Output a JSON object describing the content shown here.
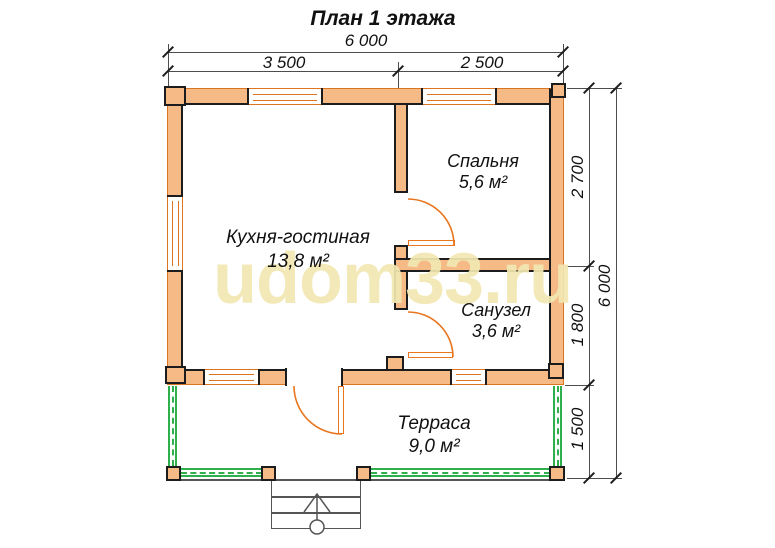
{
  "title": "План 1 этажа",
  "watermark": "udom33.ru",
  "dims": {
    "top_total": "6 000",
    "top_left": "3 500",
    "top_right": "2 500",
    "right_seg1": "2 700",
    "right_seg2": "1 800",
    "right_seg3": "1 500",
    "right_total": "6 000"
  },
  "rooms": {
    "kitchen": {
      "name": "Кухня-гостиная",
      "area": "13,8 м²"
    },
    "bedroom": {
      "name": "Спальня",
      "area": "5,6 м²"
    },
    "bathroom": {
      "name": "Санузел",
      "area": "3,6 м²"
    },
    "terrace": {
      "name": "Терраса",
      "area": "9,0 м²"
    }
  },
  "colors": {
    "wall_fill": "#F5BA85",
    "wall_outline": "#DD7420",
    "inner_line": "#1c1c1c",
    "door_arc": "#E8761F",
    "railing_green": "#2FB04C",
    "watermark_yellow": "#F2E8B2",
    "dim_line_gray": "#4d4d4d"
  }
}
